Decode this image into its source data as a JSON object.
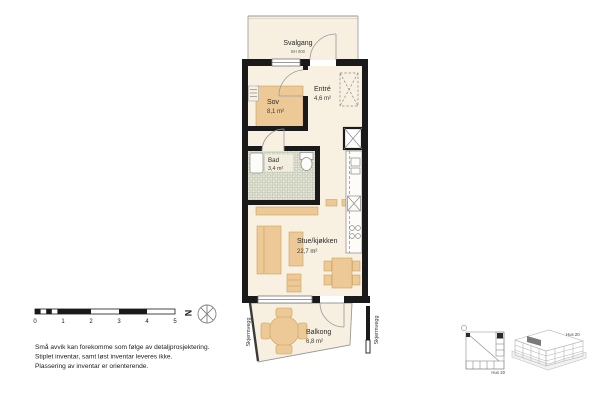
{
  "rooms": {
    "svalgang": {
      "name": "Svalgang",
      "note": "BH 900"
    },
    "sov": {
      "name": "Sov",
      "area": "8,1 m²"
    },
    "entre": {
      "name": "Entré",
      "area": "4,6 m²"
    },
    "bad": {
      "name": "Bad",
      "area": "3,4 m²"
    },
    "stue": {
      "name": "Stue/kjøkken",
      "area": "22,7 m²"
    },
    "balkong": {
      "name": "Balkong",
      "area": "6,8 m²"
    }
  },
  "screen_walls": {
    "left": "Skjermvegg",
    "right": "Skjermvegg"
  },
  "scale_bar": {
    "ticks": [
      "0",
      "1",
      "2",
      "3",
      "4",
      "5"
    ]
  },
  "north": {
    "label": "N"
  },
  "notes": [
    "Små avvik kan forekomme som følge av detaljprosjektering.",
    "Stiplet inventar, samt løst inventar leveres ikke.",
    "Plassering av inventar er orienterende."
  ],
  "locator": {
    "key_plan_label": "Hus 20",
    "model_label": "Hus 20"
  },
  "colors": {
    "floor": "#f8f1e2",
    "furniture": "#ecc996",
    "furniture_edge": "#c9a25c",
    "wall": "#1a1a1a",
    "thin_line": "#999999",
    "tile_base": "#e9e9da",
    "tile_line": "#b3baa6"
  }
}
